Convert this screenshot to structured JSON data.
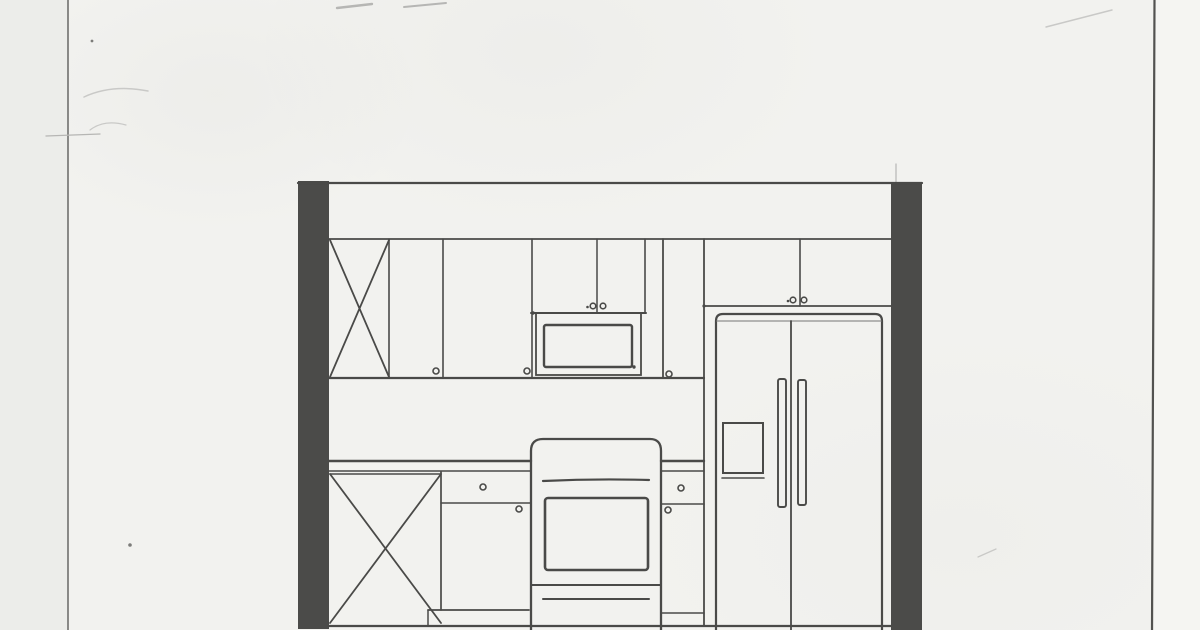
{
  "document": {
    "kind": "scanned-pencil-sketch",
    "subject": "kitchen-elevation"
  },
  "canvas": {
    "width": 1200,
    "height": 630
  },
  "palette": {
    "paper": "#f2f2ef",
    "paper_left": "#ecedea",
    "paper_right": "#f5f5f2",
    "ink": "#4a4a48",
    "ink_light": "#90908e",
    "wall": "#4b4b49",
    "edge": "#70706e",
    "edge_dark": "#525250",
    "smudge": "#b6b6b4",
    "smudge_light": "#c9c9c7",
    "speck": "#7c7c7a"
  },
  "components": [
    "left-wall",
    "right-wall",
    "upper-cabinets",
    "diagonal-marked-cabinets",
    "over-microwave-cabinet",
    "microwave",
    "over-refrigerator-cabinet",
    "refrigerator-double-door",
    "countertop",
    "base-cabinets",
    "range-with-oven-window"
  ],
  "shapes": [
    {
      "n": "paper-left-edge-line",
      "t": "line",
      "x1": 68,
      "y1": 0,
      "x2": 68,
      "y2": 630,
      "s": "edge",
      "w": 1.6
    },
    {
      "n": "paper-right-edge-line",
      "t": "line",
      "x1": 1154.5,
      "y1": 0,
      "x2": 1152,
      "y2": 630,
      "s": "edge_dark",
      "w": 2.2
    },
    {
      "n": "pencil-smudge-top-1",
      "t": "line",
      "x1": 337,
      "y1": 8,
      "x2": 372,
      "y2": 4,
      "s": "smudge",
      "w": 2.4
    },
    {
      "n": "pencil-smudge-top-2",
      "t": "line",
      "x1": 404,
      "y1": 7,
      "x2": 446,
      "y2": 3,
      "s": "smudge",
      "w": 2.0
    },
    {
      "n": "pencil-scratch-top-right",
      "t": "line",
      "x1": 1046,
      "y1": 27,
      "x2": 1112,
      "y2": 10,
      "s": "smudge_light",
      "w": 1.5
    },
    {
      "n": "pencil-smudge-left-1",
      "t": "path",
      "d": "M84,97 Q112,84 148,91",
      "s": "smudge_light",
      "w": 1.5
    },
    {
      "n": "pencil-smudge-left-2",
      "t": "path",
      "d": "M90,130 Q104,119 126,125",
      "s": "smudge_light",
      "w": 1.2
    },
    {
      "n": "pencil-dash-left",
      "t": "line",
      "x1": 46,
      "y1": 136,
      "x2": 100,
      "y2": 134,
      "s": "smudge",
      "w": 1.3
    },
    {
      "n": "pencil-mark-bottom-right",
      "t": "line",
      "x1": 978,
      "y1": 557,
      "x2": 996,
      "y2": 549,
      "s": "smudge_light",
      "w": 1.3
    },
    {
      "n": "paper-speck-1",
      "t": "circle",
      "cx": 130,
      "cy": 545,
      "r": 1.8,
      "f": "speck",
      "s": "none",
      "w": 0
    },
    {
      "n": "paper-speck-2",
      "t": "circle",
      "cx": 92,
      "cy": 41,
      "r": 1.4,
      "f": "speck",
      "s": "none",
      "w": 0
    },
    {
      "n": "construction-line-right-wall",
      "t": "line",
      "x1": 896,
      "y1": 164,
      "x2": 896,
      "y2": 184,
      "s": "smudge",
      "w": 1.2
    },
    {
      "n": "wall-section-left",
      "t": "rect",
      "x": 298,
      "y": 181,
      "wd": 31,
      "h": 448,
      "f": "wall",
      "s": "none",
      "w": 0
    },
    {
      "n": "wall-section-right",
      "t": "rect",
      "x": 891,
      "y": 183,
      "wd": 31,
      "h": 447,
      "f": "wall",
      "s": "none",
      "w": 0
    },
    {
      "n": "ceiling-line",
      "t": "line",
      "x1": 298,
      "y1": 183,
      "x2": 922,
      "y2": 183,
      "w": 2.2
    },
    {
      "n": "floor-line",
      "t": "line",
      "x1": 329,
      "y1": 626,
      "x2": 891,
      "y2": 626,
      "w": 2.2
    },
    {
      "n": "soffit-bottom-line",
      "t": "line",
      "x1": 329,
      "y1": 239,
      "x2": 891,
      "y2": 239,
      "w": 1.8
    },
    {
      "n": "upper-cabinets-bottom-line",
      "t": "line",
      "x1": 329,
      "y1": 378,
      "x2": 704,
      "y2": 378,
      "w": 2.2
    },
    {
      "n": "upper-x-cabinet-diagonal-1",
      "t": "line",
      "x1": 330,
      "y1": 240,
      "x2": 389,
      "y2": 377,
      "w": 1.8
    },
    {
      "n": "upper-x-cabinet-diagonal-2",
      "t": "line",
      "x1": 389,
      "y1": 240,
      "x2": 330,
      "y2": 377,
      "w": 1.8
    },
    {
      "n": "upper-divider-1",
      "t": "line",
      "x1": 389,
      "y1": 239,
      "x2": 389,
      "y2": 378,
      "w": 1.6
    },
    {
      "n": "upper-divider-2",
      "t": "line",
      "x1": 443,
      "y1": 239,
      "x2": 443,
      "y2": 378,
      "w": 1.6
    },
    {
      "n": "upper-divider-3",
      "t": "line",
      "x1": 532,
      "y1": 239,
      "x2": 532,
      "y2": 378,
      "w": 1.6
    },
    {
      "n": "upper-divider-4",
      "t": "line",
      "x1": 663,
      "y1": 239,
      "x2": 663,
      "y2": 378,
      "w": 1.8
    },
    {
      "n": "over-microwave-cabinet-right-edge",
      "t": "line",
      "x1": 645,
      "y1": 239,
      "x2": 645,
      "y2": 313,
      "w": 1.6
    },
    {
      "n": "over-microwave-cabinet-split",
      "t": "line",
      "x1": 597,
      "y1": 239,
      "x2": 597,
      "y2": 313,
      "w": 1.5
    },
    {
      "n": "microwave-shelf-line",
      "t": "line",
      "x1": 531,
      "y1": 313,
      "x2": 646,
      "y2": 313,
      "w": 2.0
    },
    {
      "n": "microwave-body",
      "t": "rect",
      "x": 536,
      "y": 313,
      "wd": 105,
      "h": 62,
      "w": 1.8
    },
    {
      "n": "microwave-window",
      "t": "rect",
      "x": 544,
      "y": 325,
      "wd": 88,
      "h": 42,
      "w": 2.4,
      "rx": 2
    },
    {
      "n": "microwave-dot",
      "t": "circle",
      "cx": 634,
      "cy": 367,
      "r": 1.7,
      "f": "ink",
      "s": "none",
      "w": 0
    },
    {
      "n": "cabinet-knob-1",
      "t": "circle",
      "cx": 436,
      "cy": 371,
      "r": 3,
      "w": 1.6
    },
    {
      "n": "cabinet-knob-2",
      "t": "circle",
      "cx": 527,
      "cy": 371,
      "r": 3,
      "w": 1.6
    },
    {
      "n": "cabinet-knob-3",
      "t": "circle",
      "cx": 593,
      "cy": 306,
      "r": 2.8,
      "w": 1.6
    },
    {
      "n": "cabinet-knob-4",
      "t": "circle",
      "cx": 603,
      "cy": 306,
      "r": 2.8,
      "w": 1.6
    },
    {
      "n": "cabinet-knob-dot-1",
      "t": "circle",
      "cx": 587.5,
      "cy": 307,
      "r": 1.3,
      "f": "ink",
      "s": "none",
      "w": 0
    },
    {
      "n": "cabinet-knob-5",
      "t": "circle",
      "cx": 669,
      "cy": 374,
      "r": 3,
      "w": 1.6
    },
    {
      "n": "cabinet-knob-6",
      "t": "circle",
      "cx": 793,
      "cy": 300,
      "r": 2.8,
      "w": 1.6
    },
    {
      "n": "cabinet-knob-7",
      "t": "circle",
      "cx": 804,
      "cy": 300,
      "r": 2.8,
      "w": 1.6
    },
    {
      "n": "cabinet-knob-dot-2",
      "t": "circle",
      "cx": 788,
      "cy": 301,
      "r": 1.3,
      "f": "ink",
      "s": "none",
      "w": 0
    },
    {
      "n": "fridge-enclosure-left-panel",
      "t": "line",
      "x1": 704,
      "y1": 239,
      "x2": 704,
      "y2": 626,
      "w": 1.8
    },
    {
      "n": "fridge-soffit-line",
      "t": "line",
      "x1": 704,
      "y1": 306,
      "x2": 891,
      "y2": 306,
      "w": 1.8
    },
    {
      "n": "over-fridge-cabinet-split",
      "t": "line",
      "x1": 800,
      "y1": 239,
      "x2": 800,
      "y2": 306,
      "w": 1.6
    },
    {
      "n": "fridge-outline",
      "t": "path",
      "d": "M716,630 L716,321 Q716,314 723,314 L875,314 Q882,314 882,321 L882,630",
      "w": 2.2
    },
    {
      "n": "fridge-inner-top",
      "t": "line",
      "x1": 717,
      "y1": 321,
      "x2": 881,
      "y2": 321,
      "s": "ink_light",
      "w": 1.2
    },
    {
      "n": "fridge-center-gap",
      "t": "line",
      "x1": 791,
      "y1": 321,
      "x2": 791,
      "y2": 630,
      "w": 1.8
    },
    {
      "n": "fridge-handle-left",
      "t": "rect",
      "x": 778,
      "y": 379,
      "wd": 8,
      "h": 128,
      "w": 1.9,
      "rx": 2
    },
    {
      "n": "fridge-handle-right",
      "t": "rect",
      "x": 798,
      "y": 380,
      "wd": 8,
      "h": 125,
      "w": 1.9,
      "rx": 2
    },
    {
      "n": "fridge-dispenser-panel",
      "t": "rect",
      "x": 723,
      "y": 423,
      "wd": 40,
      "h": 50,
      "w": 2.0
    },
    {
      "n": "fridge-dispenser-bottom",
      "t": "line",
      "x1": 722,
      "y1": 478,
      "x2": 764,
      "y2": 478,
      "w": 1.6
    },
    {
      "n": "countertop-left-top",
      "t": "line",
      "x1": 329,
      "y1": 461,
      "x2": 531,
      "y2": 461,
      "w": 2.4
    },
    {
      "n": "countertop-left-bottom",
      "t": "line",
      "x1": 329,
      "y1": 471,
      "x2": 531,
      "y2": 471,
      "w": 1.5
    },
    {
      "n": "countertop-right-top",
      "t": "line",
      "x1": 661,
      "y1": 461,
      "x2": 704,
      "y2": 461,
      "w": 2.4
    },
    {
      "n": "countertop-right-bottom",
      "t": "line",
      "x1": 661,
      "y1": 471,
      "x2": 704,
      "y2": 471,
      "w": 1.5
    },
    {
      "n": "base-x-cabinet-top",
      "t": "line",
      "x1": 330,
      "y1": 474,
      "x2": 441,
      "y2": 474,
      "w": 1.5
    },
    {
      "n": "base-x-cabinet-diagonal-1",
      "t": "line",
      "x1": 330,
      "y1": 474,
      "x2": 441,
      "y2": 623,
      "w": 1.8
    },
    {
      "n": "base-x-cabinet-diagonal-2",
      "t": "line",
      "x1": 441,
      "y1": 474,
      "x2": 330,
      "y2": 623,
      "w": 1.8
    },
    {
      "n": "base-x-cabinet-right-edge",
      "t": "line",
      "x1": 441,
      "y1": 472,
      "x2": 441,
      "y2": 610,
      "w": 1.7
    },
    {
      "n": "base-drawer-line-left",
      "t": "line",
      "x1": 441,
      "y1": 503,
      "x2": 531,
      "y2": 503,
      "w": 1.6
    },
    {
      "n": "base-knob-1",
      "t": "circle",
      "cx": 483,
      "cy": 487,
      "r": 3,
      "w": 1.6
    },
    {
      "n": "base-knob-2",
      "t": "circle",
      "cx": 519,
      "cy": 509,
      "r": 3,
      "w": 1.6
    },
    {
      "n": "toe-kick-step-top",
      "t": "line",
      "x1": 428,
      "y1": 610,
      "x2": 529,
      "y2": 610,
      "w": 1.8
    },
    {
      "n": "toe-kick-step-left",
      "t": "line",
      "x1": 428,
      "y1": 610,
      "x2": 428,
      "y2": 626,
      "w": 1.5
    },
    {
      "n": "range-outline",
      "t": "path",
      "d": "M531,630 L531,451 Q531,439 543,439 L650,439 Q661,439 661,451 L661,630",
      "w": 2.3
    },
    {
      "n": "range-control-line",
      "t": "path",
      "d": "M543,481 Q596,478.5 649,480",
      "w": 2.2
    },
    {
      "n": "oven-window",
      "t": "rect",
      "x": 545,
      "y": 498,
      "wd": 103,
      "h": 72,
      "w": 2.6,
      "rx": 3
    },
    {
      "n": "oven-door-bottom",
      "t": "line",
      "x1": 532,
      "y1": 585,
      "x2": 660,
      "y2": 585,
      "w": 2.0
    },
    {
      "n": "range-drawer-line",
      "t": "line",
      "x1": 543,
      "y1": 599,
      "x2": 649,
      "y2": 599,
      "w": 2.0
    },
    {
      "n": "base-drawer-line-right",
      "t": "line",
      "x1": 661,
      "y1": 504,
      "x2": 704,
      "y2": 504,
      "w": 1.6
    },
    {
      "n": "base-cabinet-right-bottom",
      "t": "line",
      "x1": 661,
      "y1": 613,
      "x2": 704,
      "y2": 613,
      "w": 1.6
    },
    {
      "n": "base-knob-3",
      "t": "circle",
      "cx": 681,
      "cy": 488,
      "r": 3,
      "w": 1.6
    },
    {
      "n": "base-knob-4",
      "t": "circle",
      "cx": 668,
      "cy": 510,
      "r": 3,
      "w": 1.6
    },
    {
      "n": "ink-pool-dot-1",
      "t": "circle",
      "cx": 533,
      "cy": 313,
      "r": 1.7,
      "f": "ink",
      "s": "none",
      "w": 0
    },
    {
      "n": "ink-pool-dot-2",
      "t": "circle",
      "cx": 704,
      "cy": 306,
      "r": 1.6,
      "f": "ink",
      "s": "none",
      "w": 0
    }
  ]
}
